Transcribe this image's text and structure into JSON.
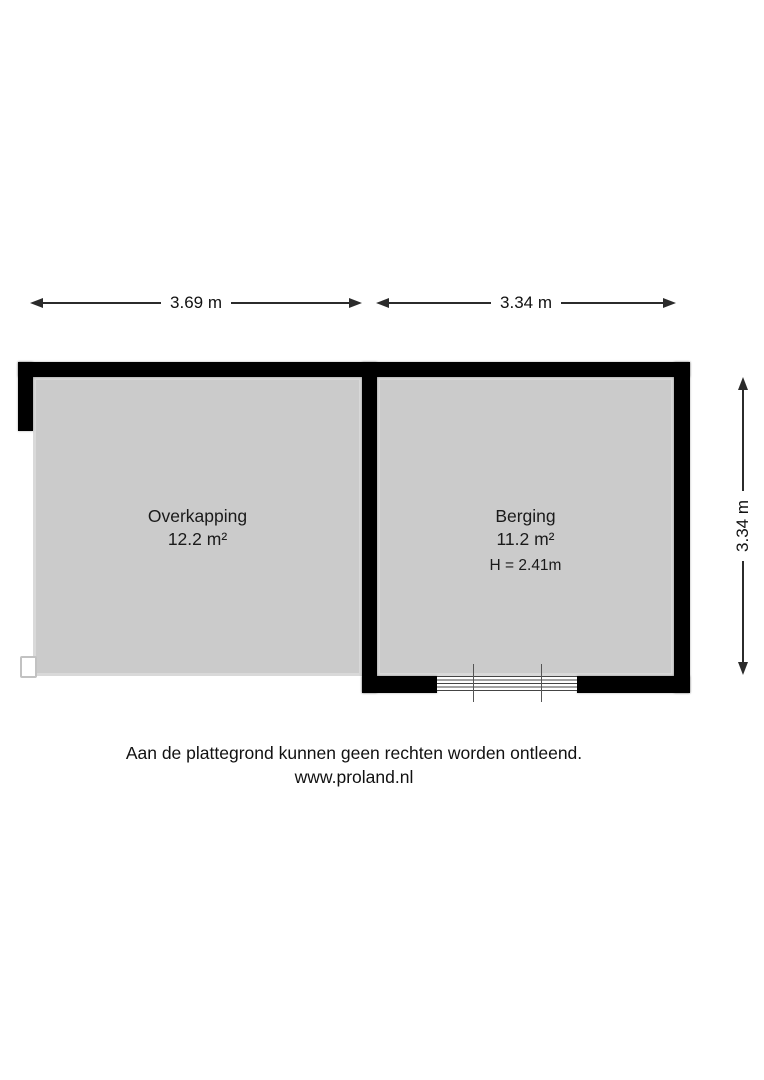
{
  "plan": {
    "colors": {
      "wall": "#000000",
      "floor": "#cbcbcb",
      "dimension_line": "#2b2b2b",
      "background": "#ffffff"
    },
    "rooms": [
      {
        "name": "Overkapping",
        "area": "12.2 m²"
      },
      {
        "name": "Berging",
        "area": "11.2 m²",
        "ceiling_height": "H = 2.41m"
      }
    ],
    "dimensions": {
      "overkapping_width": "3.69 m",
      "berging_width": "3.34 m",
      "berging_depth": "3.34 m"
    }
  },
  "footer": {
    "disclaimer": "Aan de plattegrond kunnen geen rechten worden ontleend.",
    "website": "www.proland.nl"
  }
}
